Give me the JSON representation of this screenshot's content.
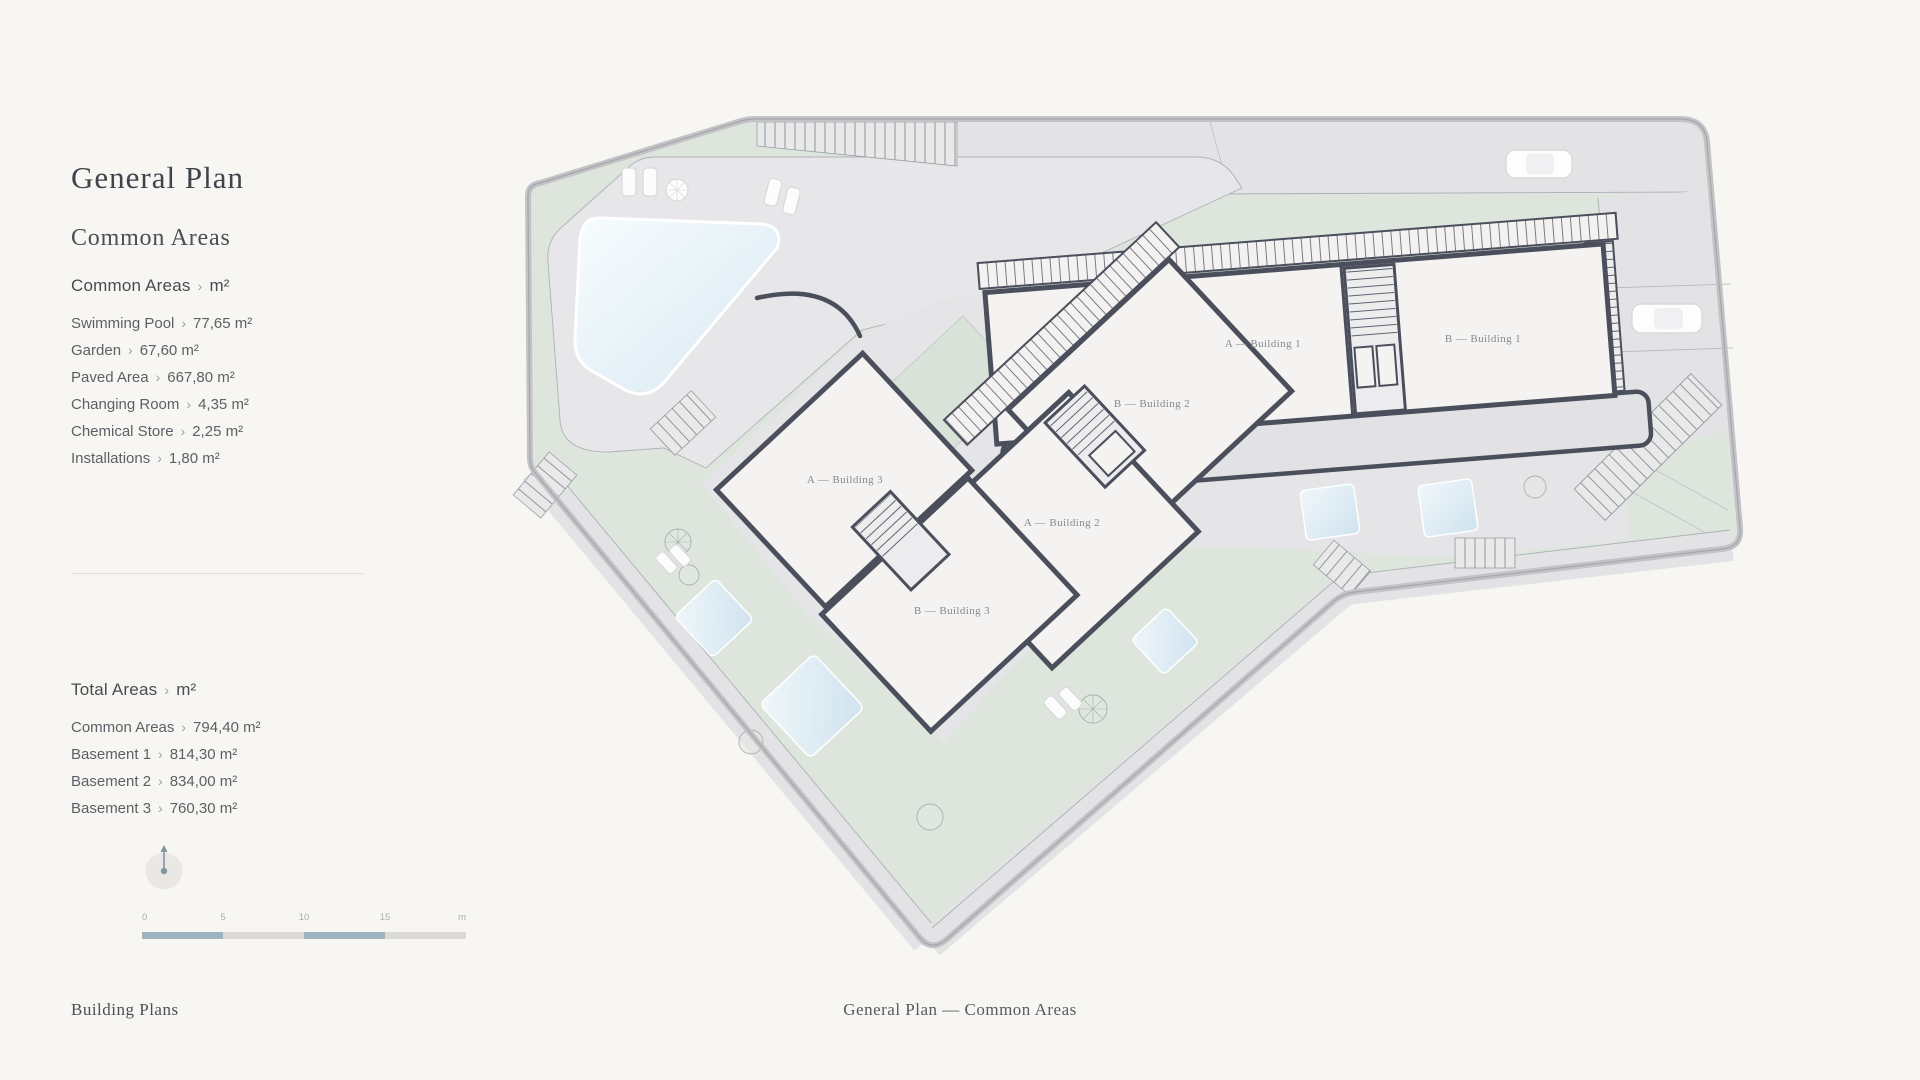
{
  "page_background": "#f8f6f2",
  "sidebar": {
    "title": "General Plan",
    "subtitle": "Common Areas",
    "separator": "›",
    "section1": {
      "heading": "Common Areas",
      "unit": "m²",
      "items": [
        {
          "label": "Swimming Pool",
          "value": "77,65 m²"
        },
        {
          "label": "Garden",
          "value": "67,60 m²"
        },
        {
          "label": "Paved Area",
          "value": "667,80 m²"
        },
        {
          "label": "Changing Room",
          "value": "4,35 m²"
        },
        {
          "label": "Chemical Store",
          "value": "2,25 m²"
        },
        {
          "label": "Installations",
          "value": "1,80 m²"
        }
      ]
    },
    "section2": {
      "heading": "Total Areas",
      "unit": "m²",
      "items": [
        {
          "label": "Common Areas",
          "value": "794,40 m²"
        },
        {
          "label": "Basement 1",
          "value": "814,30 m²"
        },
        {
          "label": "Basement 2",
          "value": "834,00 m²"
        },
        {
          "label": "Basement 3",
          "value": "760,30 m²"
        }
      ]
    },
    "scale": {
      "ticks": [
        "0",
        "5",
        "10",
        "15"
      ],
      "unit": "m"
    }
  },
  "plan": {
    "buildings": [
      {
        "id": "a1",
        "label": "A — Building 1"
      },
      {
        "id": "b1",
        "label": "B — Building 1"
      },
      {
        "id": "b2",
        "label": "B — Building 2"
      },
      {
        "id": "a2",
        "label": "A — Building 2"
      },
      {
        "id": "a3",
        "label": "A — Building 3"
      },
      {
        "id": "b3",
        "label": "B — Building 3"
      }
    ],
    "colors": {
      "green": "#dde5dd",
      "paved": "#e5e5e7",
      "building_fill": "#f4f3f1",
      "building_stroke": "#4b4f5c",
      "pool": "#dcecf4",
      "boundary": "#c3c3c7",
      "scale_dark": "#9fb2bf"
    }
  },
  "footer": {
    "left_link": "Building Plans",
    "center_text": "General Plan — Common Areas"
  }
}
